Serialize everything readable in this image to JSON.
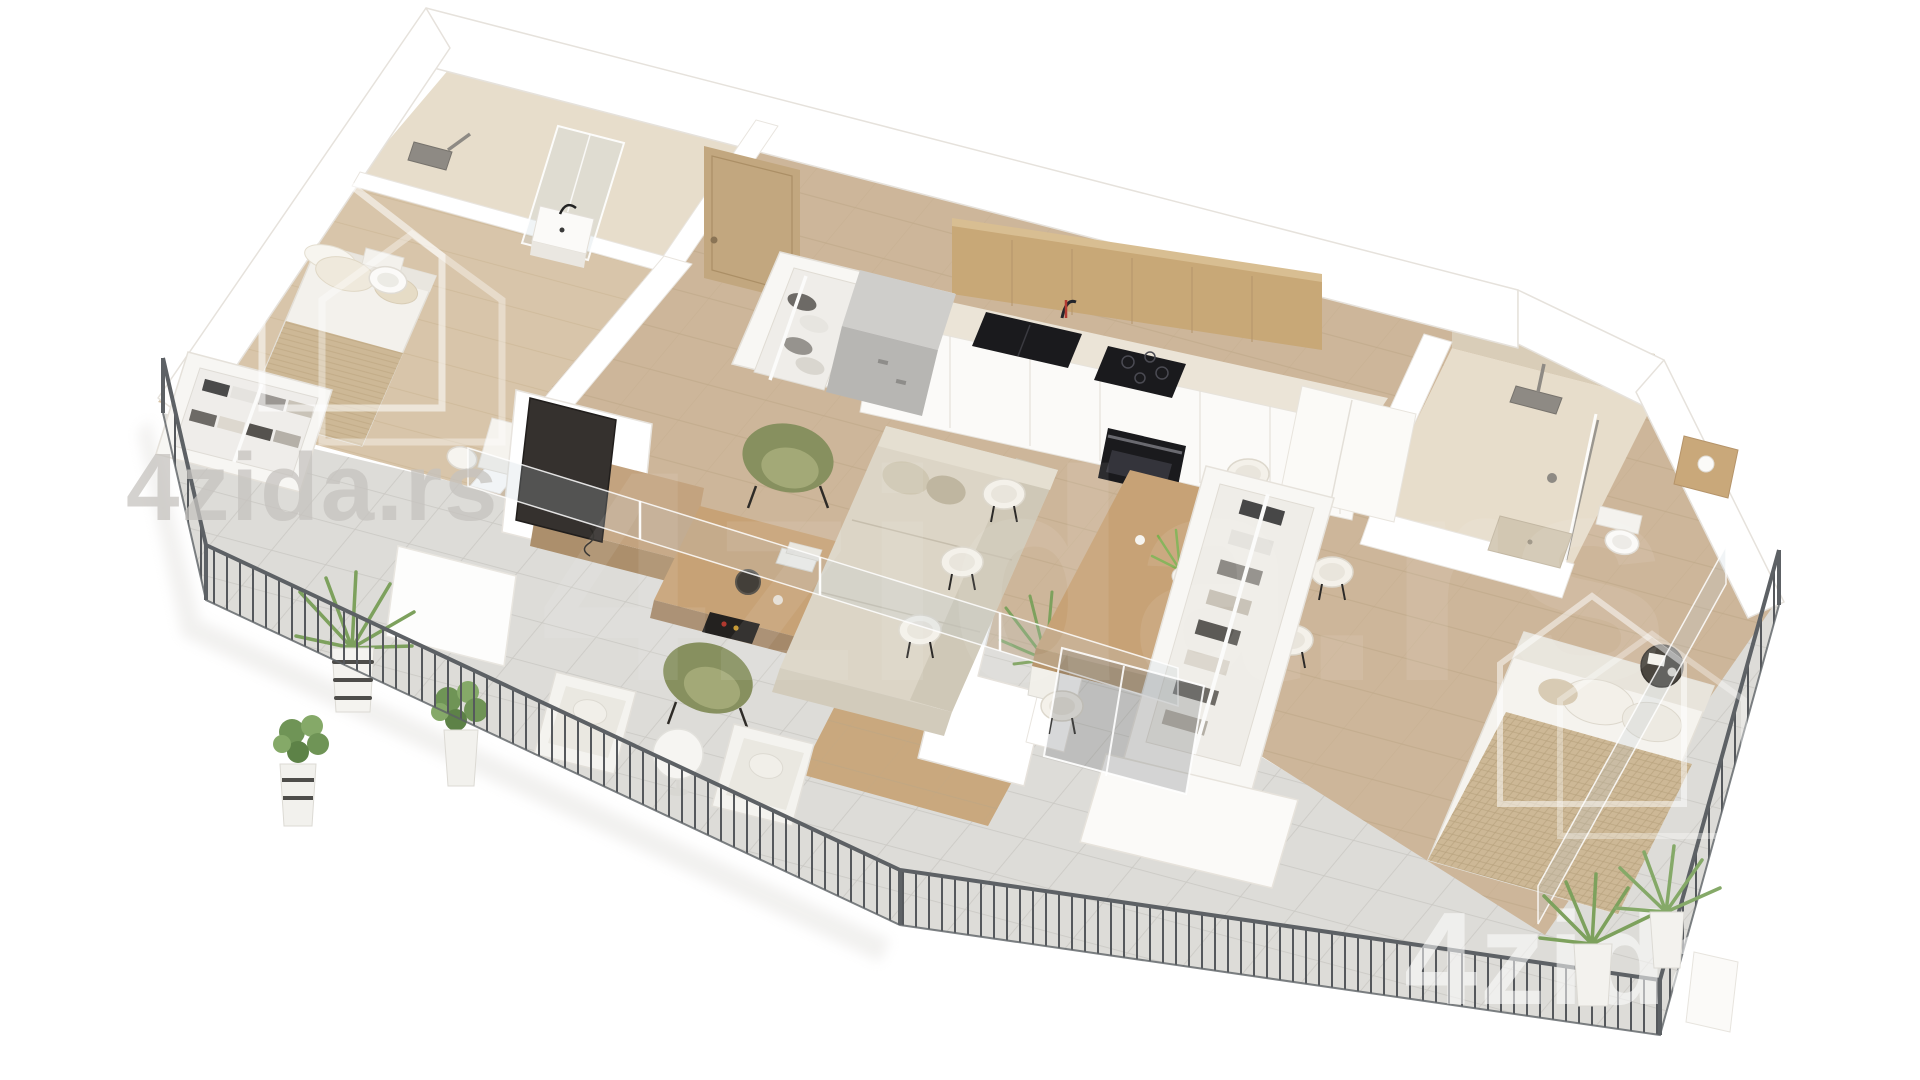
{
  "scene": {
    "description": "3D isometric render floor plan of a two-bedroom apartment with kitchen, living-dining area, two bathrooms and a wrap-around terrace",
    "brand_logo": "house-outline-icon"
  },
  "watermarks": {
    "brand_text_top_left": "4zida.rs",
    "brand_text_center": "4zida.rs",
    "brand_text_bottom_right": "4zida"
  },
  "colors": {
    "background": "#ffffff",
    "wall_white": "#ffffff",
    "wall_edge": "#e6e2dc",
    "wood_floor_main": "#cdb69a",
    "wood_floor_bedroom": "#d8c5aa",
    "terrace_tile": "#dddcd8",
    "bathroom_floor": "#e7ddcb",
    "bathroom_wall": "#d9cdb8",
    "kitchen_cabinet_wood": "#c8a877",
    "countertop": "#ebe4d7",
    "appliance_black": "#1a1a1d",
    "entry_door_wood": "#c2a77f",
    "sofa_beige": "#dcd5c6",
    "armchair_olive": "#87905f",
    "table_wood": "#c7a276",
    "bed_blanket_beige": "#cdb896",
    "plant_green": "#7da15d",
    "railing_gray": "#5d6165",
    "watermark_gray": "#c6c3bf",
    "watermark_white": "#ffffff"
  }
}
